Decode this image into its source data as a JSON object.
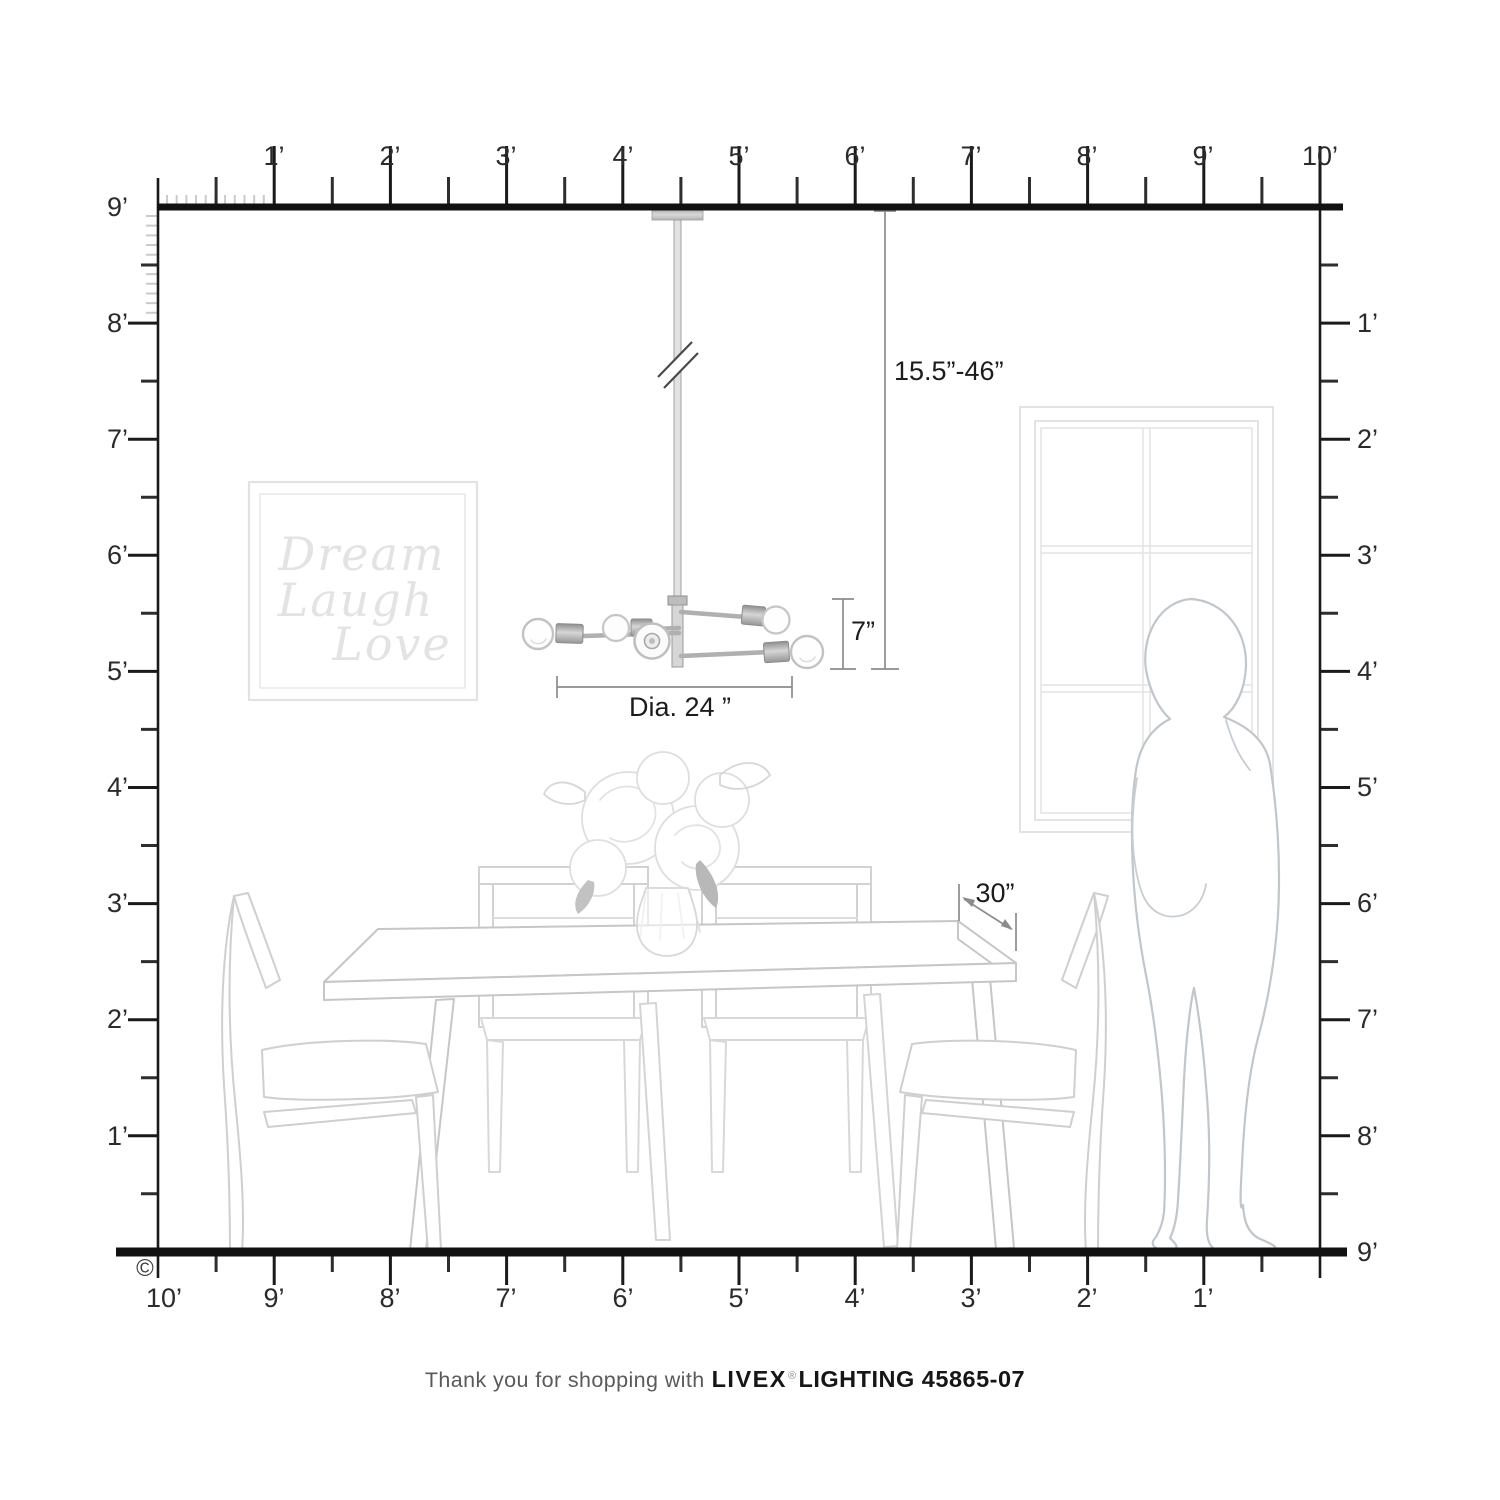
{
  "title": "Livex Lighting pendant scale diagram",
  "rulers": {
    "top": [
      "1’",
      "2’",
      "3’",
      "4’",
      "5’",
      "6’",
      "7’",
      "8’",
      "9’",
      "10’"
    ],
    "left": [
      "9’",
      "8’",
      "7’",
      "6’",
      "5’",
      "4’",
      "3’",
      "2’",
      "1’"
    ],
    "right": [
      "1’",
      "2’",
      "3’",
      "4’",
      "5’",
      "6’",
      "7’",
      "8’",
      "9’"
    ],
    "bottom": [
      "10’",
      "9’",
      "8’",
      "7’",
      "6’",
      "5’",
      "4’",
      "3’",
      "2’",
      "1’"
    ]
  },
  "dimensions": {
    "hanging_height": "15.5”-46”",
    "fixture_height": "7”",
    "diameter": "Dia. 24 ”",
    "table_clearance": "30”"
  },
  "art_print": {
    "line1": "Dream",
    "line2": "Laugh",
    "line3": "Love"
  },
  "caption": {
    "prefix": "Thank you for shopping with",
    "brand": "LIVEX",
    "registered": "®",
    "product": "LIGHTING 45865-07"
  },
  "copyright_symbol": "©",
  "colors": {
    "ruler": "#1a1a1a",
    "dimension_line": "#8c8c8c",
    "faint_art": "#dcdcdc",
    "person_outline": "#c2c6ca",
    "metal": "#b9b9b9"
  }
}
